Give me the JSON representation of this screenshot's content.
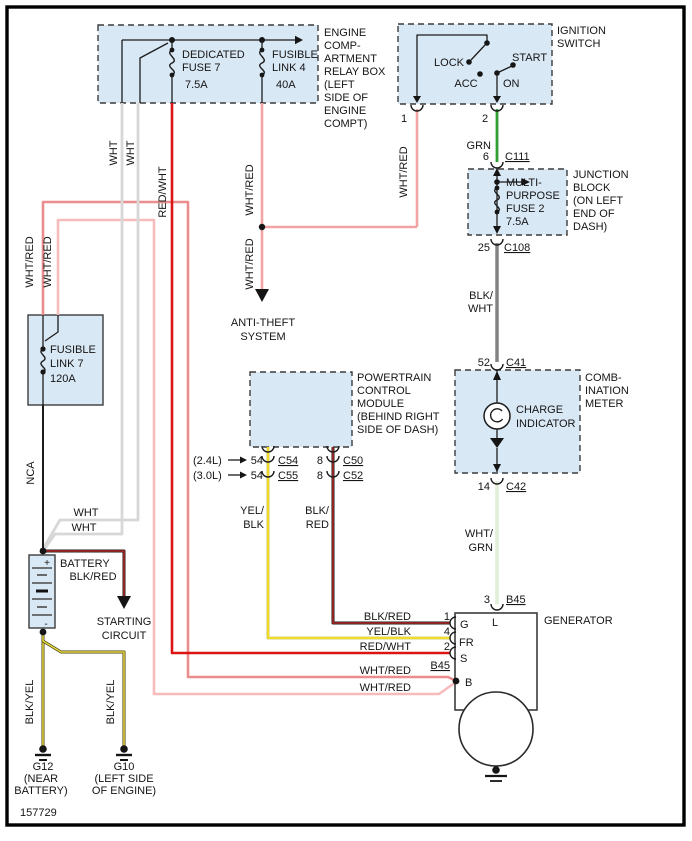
{
  "page": {
    "diagram_number": "157729"
  },
  "colors": {
    "component_fill": "#d9e8f5",
    "wht_red": "#f2a3a3",
    "red_wht": "#dc1414",
    "grn": "#2f9e33",
    "wht_grn": "#cfe3c0",
    "wht": "#d7d7d7",
    "blk_red": "#cf2a2a",
    "yel_blk": "#f6e62e",
    "blk_yel": "#e9d73a",
    "blk": "#1c1c1c"
  },
  "relay_box": {
    "name_lines": [
      "ENGINE",
      "COMP-",
      "ARTMENT",
      "RELAY BOX",
      "(LEFT",
      "SIDE OF",
      "ENGINE",
      "COMPT)"
    ],
    "fuse7_lines": [
      "DEDICATED",
      "FUSE 7",
      "7.5A"
    ],
    "link4_lines": [
      "FUSIBLE",
      "LINK 4",
      "40A"
    ]
  },
  "ignition": {
    "name_lines": [
      "IGNITION",
      "SWITCH"
    ],
    "lock": "LOCK",
    "acc": "ACC",
    "on": "ON",
    "start": "START",
    "pin1": "1",
    "pin2": "2"
  },
  "junction": {
    "name_lines": [
      "JUNCTION",
      "BLOCK",
      "(ON LEFT",
      "END OF",
      "DASH)"
    ],
    "fuse_lines": [
      "MULTI-",
      "PURPOSE",
      "FUSE 2",
      "7.5A"
    ],
    "pin_in": "6",
    "conn_in": "C111",
    "pin_out": "25",
    "conn_out": "C108"
  },
  "meter": {
    "name_lines": [
      "COMB-",
      "INATION",
      "METER"
    ],
    "charge_lines": [
      "CHARGE",
      "INDICATOR"
    ],
    "pin_in": "52",
    "conn_in": "C41",
    "pin_out": "14",
    "conn_out": "C42"
  },
  "fusible_link7": {
    "lines": [
      "FUSIBLE",
      "LINK 7",
      "120A"
    ]
  },
  "battery": {
    "name": "BATTERY",
    "plus": "+",
    "minus": "-"
  },
  "pcm": {
    "name_lines": [
      "POWERTRAIN",
      "CONTROL",
      "MODULE",
      "(BEHIND RIGHT",
      "SIDE OF DASH)"
    ],
    "row1": {
      "engine": "(2.4L)",
      "pin_a": "54",
      "conn_a": "C54",
      "pin_b": "8",
      "conn_b": "C50"
    },
    "row2": {
      "engine": "(3.0L)",
      "pin_a": "54",
      "conn_a": "C55",
      "pin_b": "8",
      "conn_b": "C52"
    }
  },
  "generator": {
    "name": "GENERATOR",
    "pin3": "3",
    "conn3": "B45",
    "term_l": "L",
    "term_g": "G",
    "term_fr": "FR",
    "term_s": "S",
    "term_b": "B",
    "pin1": "1",
    "pin4": "4",
    "pin2": "2",
    "conn_b45": "B45"
  },
  "grounds": {
    "g12": {
      "id": "G12",
      "loc_lines": [
        "(NEAR",
        "BATTERY)"
      ]
    },
    "g10": {
      "id": "G10",
      "loc_lines": [
        "(LEFT SIDE",
        "OF ENGINE)"
      ]
    }
  },
  "destinations": {
    "anti_theft_lines": [
      "ANTI-THEFT",
      "SYSTEM"
    ],
    "starting_lines": [
      "STARTING",
      "CIRCUIT"
    ]
  },
  "wire_labels": {
    "wht_red": "WHT/RED",
    "red_wht": "RED/WHT",
    "wht": "WHT",
    "grn": "GRN",
    "nca": "NCA",
    "blk_red": "BLK/RED",
    "yel_blk": "YEL/BLK",
    "blk_yel": "BLK/YEL",
    "blk_wht_stack": [
      "BLK/",
      "WHT"
    ],
    "wht_grn_stack": [
      "WHT/",
      "GRN"
    ],
    "yel_blk_stack": [
      "YEL/",
      "BLK"
    ],
    "blk_red_stack": [
      "BLK/",
      "RED"
    ]
  }
}
